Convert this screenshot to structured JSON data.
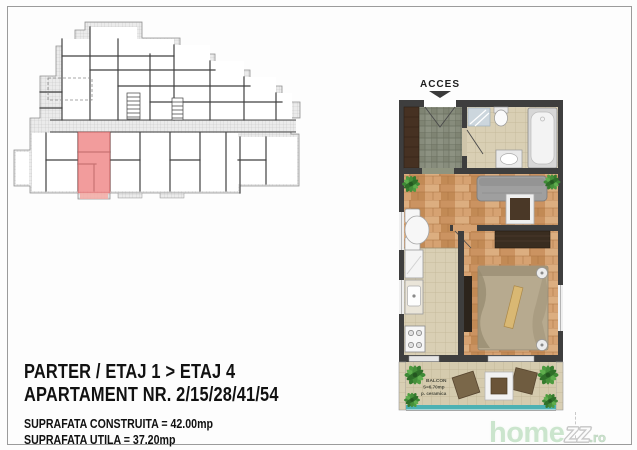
{
  "apartment_plan": {
    "acces_label": "ACCES",
    "balcony": {
      "name_label": "BALCON",
      "area_label": "S=6.70mp",
      "finish_label": "p. ceramica"
    }
  },
  "overview_plan": {
    "description": "building floor overview with selected unit highlighted",
    "highlight_color": "#ee8080"
  },
  "info": {
    "floors_line": "PARTER / ETAJ 1 > ETAJ 4",
    "apartment_line": "APARTAMENT NR. 2/15/28/41/54",
    "built_area_line": "SUPRAFATA CONSTRUITA = 42.00mp",
    "usable_area_line": "SUPRAFATA UTILA = 37.20mp"
  },
  "watermark": {
    "home": "home",
    "zz": "zz",
    "ro": ".ro"
  },
  "palette": {
    "wall": "#3e3e3e",
    "wood_floor": "#d29e6b",
    "slate_tile": "#878c7c",
    "beige_tile": "#d9cfb4",
    "highlight_red": "#ee8080",
    "railing_teal": "#4db1b3",
    "plant_green": "#3e8a36",
    "watermark_green": "#cbe5cd"
  }
}
